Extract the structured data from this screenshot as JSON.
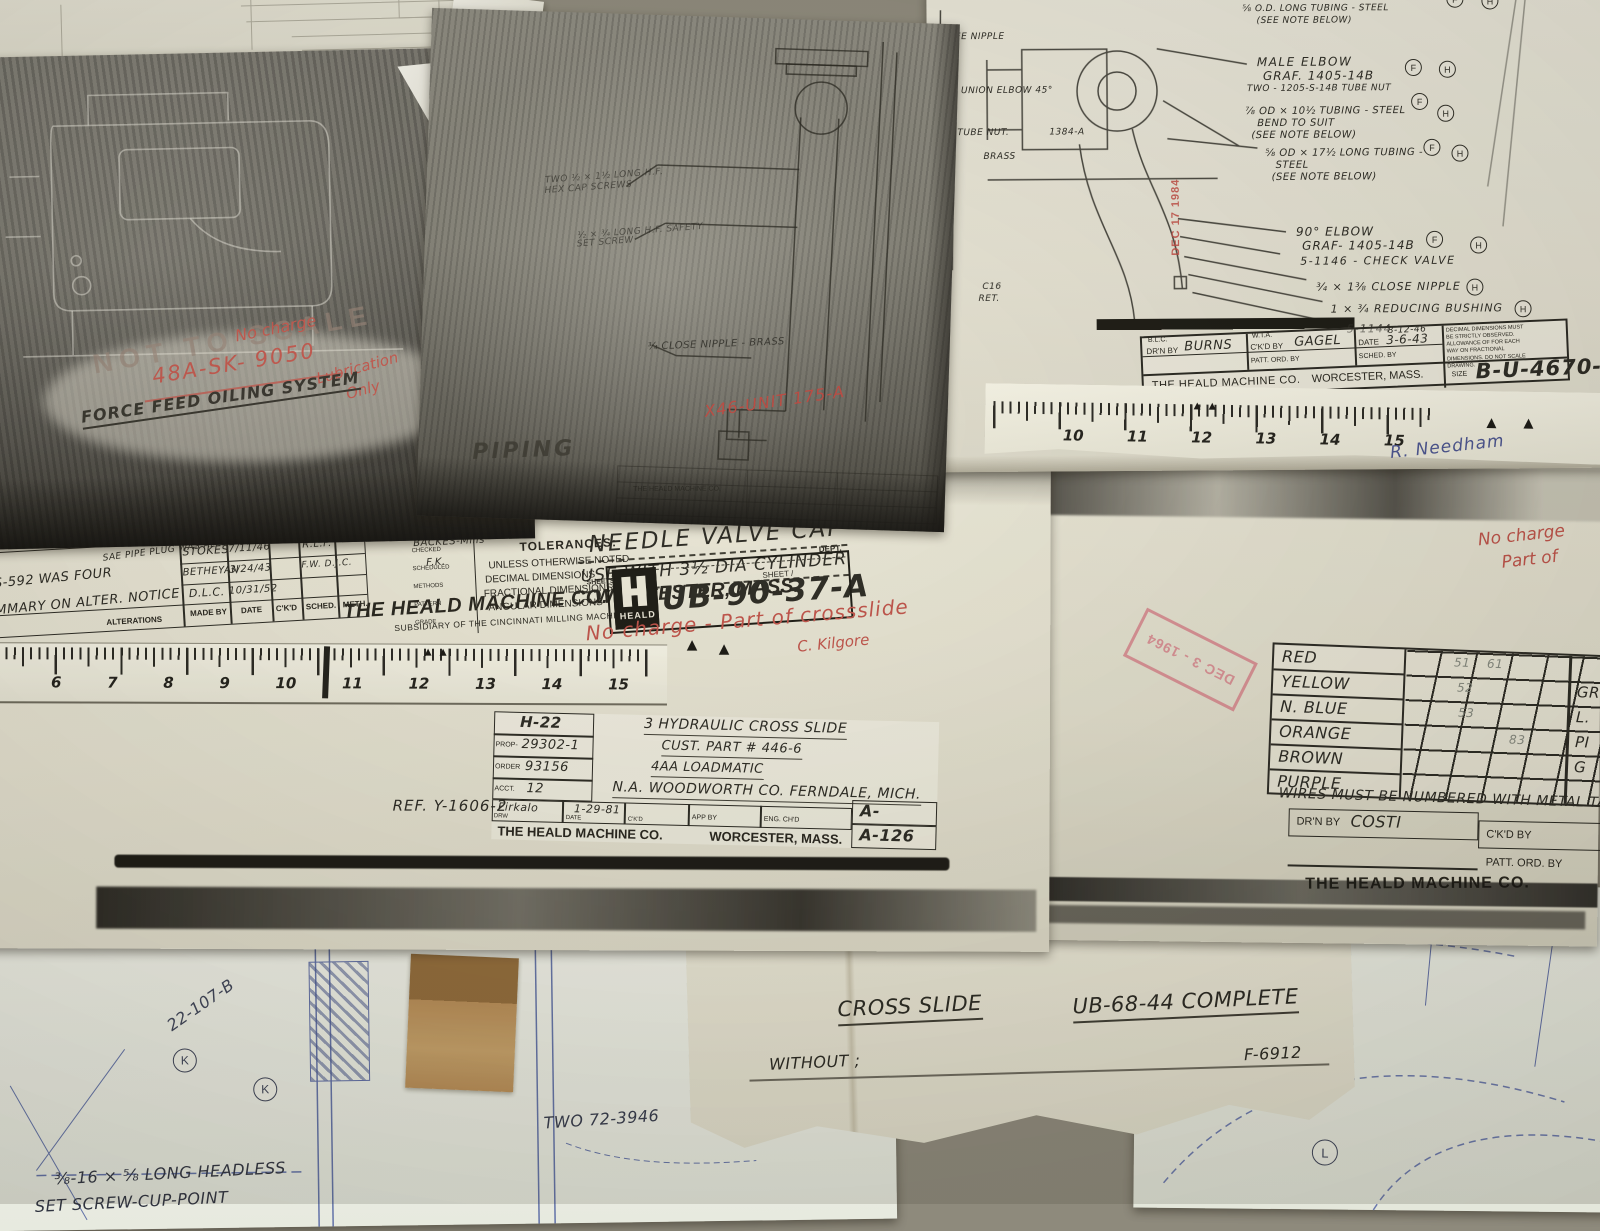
{
  "dark_print_left": {
    "stamp_not_to_scale": "NOT TO SCALE",
    "red_no_charge": "No charge",
    "red_sketch_number": "48A-SK- 9050",
    "red_lubrication": "Lubrication",
    "red_only": "Only",
    "system_title": "FORCE FEED OILING SYSTEM"
  },
  "dark_print_mid": {
    "note_cap_screws_1": "TWO ½ × 1½ LONG H.F.",
    "note_cap_screws_2": "HEX CAP SCREWS",
    "note_set_screw_1": "½ × ¾ LONG H.F. SAFETY",
    "note_set_screw_2": "SET SCREW",
    "note_close_nipple": "¾ CLOSE NIPPLE - BRASS",
    "red_unit": "X46-UNIT 175-A",
    "piping_label": "PIPING",
    "company_small": "THE HEALD MACHINE CO."
  },
  "sheet_b_u_4670": {
    "top_fragments": {
      "graf": "GRAF. 1405-14",
      "tubing": "⅝ O.D. LONG TUBING - STEEL",
      "see_note": "(SEE NOTE BELOW)"
    },
    "left_fragments": {
      "see_nipple": "SEE NIPPLE",
      "union_elbow": "UNION ELBOW 45°",
      "tube_nut": "TUBE NUT.",
      "part_1384": "1384-A",
      "brass": "BRASS",
      "c16": "C16",
      "ret": "RET."
    },
    "annotations": [
      {
        "l1": "MALE ELBOW",
        "l2": "GRAF. 1405-14B",
        "l3": "TWO - 1205-S-14B TUBE NUT",
        "m1": "F",
        "m2": "H"
      },
      {
        "l1": "⅞ OD × 10½ TUBING - STEEL",
        "l2": "BEND TO SUIT",
        "l3": "(SEE NOTE BELOW)",
        "m1": "F",
        "m2": "H"
      },
      {
        "l1": "⅝ OD × 17½ LONG TUBING -",
        "l2": "STEEL",
        "l3": "(SEE NOTE BELOW)",
        "m1": "F",
        "m2": "H"
      },
      {
        "l1": "90° ELBOW",
        "l2": "GRAF- 1405-14B",
        "m1": "F",
        "m2": "H"
      },
      {
        "l1": "5-1146 - CHECK VALVE"
      },
      {
        "l1": "¾ × 1⅜ CLOSE NIPPLE",
        "m1": "H"
      },
      {
        "l1": "1 × ¾ REDUCING BUSHING",
        "m1": "H"
      },
      {
        "l1": "5-1144"
      }
    ],
    "stamp_date": "DEC 17 1984",
    "title_block": {
      "drn_super": "B.L.C.",
      "drn_label": "DR'N BY",
      "drn_value": "BURNS",
      "ckd_super": "W.T.A.",
      "ckd_label": "C'K'D BY",
      "ckd_value": "GAGEL",
      "date_super": "8-12-46",
      "date_label": "DATE",
      "date_value": "3-6-43",
      "patt_label": "PATT. ORD. BY",
      "sched_label": "SCHED. BY",
      "notes": "DECIMAL DIMENSIONS MUST BE STRICTLY OBSERVED. ALLOWANCE OF FOR EACH WAY ON FRACTIONAL DIMENSIONS. DO NOT SCALE DRAWING.",
      "company": "THE HEALD MACHINE CO.",
      "city": "WORCESTER, MASS.",
      "size_label": "SIZE",
      "number": "B-U-4670-H"
    },
    "schedule_note": "SEE ALSO SCHEDULE U-4578-H"
  },
  "ruler_right": {
    "numbers": [
      "10",
      "11",
      "12",
      "13",
      "14",
      "15"
    ],
    "signature": "R. Needham"
  },
  "sheet_wires": {
    "red_note_1": "No charge",
    "red_note_2": "Part of",
    "stamp_date": "DEC 3 - 1964",
    "table_rows": [
      {
        "label": "RED",
        "v1": "51",
        "v2": "61"
      },
      {
        "label": "YELLOW",
        "v1": "52",
        "v2": ""
      },
      {
        "label": "N. BLUE",
        "v1": "53",
        "v2": ""
      },
      {
        "label": "ORANGE",
        "v1": "",
        "v2": "83"
      },
      {
        "label": "BROWN",
        "v1": "",
        "v2": ""
      },
      {
        "label": "PURPLE",
        "v1": "",
        "v2": ""
      }
    ],
    "right_fragments": [
      "GR",
      "L.",
      "PI",
      "G"
    ],
    "wires_note": "WIRES MUST BE NUMBERED WITH METAL TAGS TO",
    "drn_label": "DR'N BY",
    "drn_value": "COSTI",
    "ckd_label": "C'K'D BY",
    "date_label": "DATE",
    "patt_label": "PATT. ORD. BY",
    "sched_label": "SCH",
    "company": "THE HEALD MACHINE CO."
  },
  "sheet_ub_90_37": {
    "heat_treatment": "HEAT TREATMENT",
    "rockwell": "ROCKWELL \"C\"",
    "part_name": "NEEDLE VALVE CAP",
    "part_use": "USE WITH 3½ DIA CYLINDER",
    "tolerances_title": "TOLERANCES:",
    "tol_1": "UNLESS OTHERWISE NOTED",
    "tol_2": "DECIMAL DIMENSIONS",
    "tol_2v": "± .005",
    "tol_3": "FRACTIONAL DIMENSIONS",
    "tol_3v": "± 1/64",
    "tol_4": "ANGULAR DIMENSIONS",
    "side_rows": [
      {
        "label": "CHECKED",
        "value": "BACKES-Mills"
      },
      {
        "label": "SCHEDULED",
        "value": "F.K."
      },
      {
        "label": "METHODS",
        "value": ""
      },
      {
        "label": "PATTERN",
        "value": ""
      },
      {
        "label": "GRADE",
        "value": ""
      }
    ],
    "company": "THE HEALD MACHINE CO.",
    "city": "WORCESTER, MASS.",
    "subsidiary": "SUBSIDIARY OF THE CINCINNATI MILLING MACHINE CO.",
    "sheets_label": "SHEETS",
    "sheet_label": "SHEET /",
    "dept_label": "DEPT.",
    "logo": "HEALD",
    "number": "UB-90-37-A",
    "red_note": "No charge - Part of crossslide",
    "red_sig": "C. Kilgore",
    "alterations": {
      "frag1": "F-9285 WAS",
      "frag2": "SAE PIPE PLUG WAS ALLEN",
      "row1": "S-592 WAS FOUR",
      "row2": "...MMARY ON  ALTER.  NOTICE",
      "header": "ALTERATIONS",
      "made_by": [
        "STOKES",
        "BETHEYAN",
        "D.L.C."
      ],
      "dates": [
        "7/11/46",
        "3/24/43",
        "10/31/52"
      ],
      "sched": [
        "R.L.F.",
        "F.W. D.J.C."
      ],
      "cols": [
        "MADE BY",
        "DATE",
        "C'K'D",
        "SCHED.",
        "METH."
      ]
    }
  },
  "ruler_left": {
    "numbers": [
      "6",
      "7",
      "8",
      "9",
      "10",
      "11",
      "12",
      "13",
      "14",
      "15"
    ]
  },
  "sheet_cross_slide_block": {
    "h22": "H-22",
    "prop_label": "PROP-",
    "prop": "29302-1",
    "order_label": "ORDER",
    "order": "93156",
    "acct_label": "ACCT.",
    "acct": "12",
    "line1": "3 HYDRAULIC CROSS SLIDE",
    "line2": "CUST. PART # 446-6",
    "line3": "4AA LOADMATIC",
    "line4": "N.A. WOODWORTH CO. FERNDALE, MICH.",
    "drw_label": "DRW",
    "drw": "Firkalo",
    "date_label": "DATE",
    "date": "1-29-81",
    "ckd_label": "C'K'D",
    "app_label": "APP BY",
    "eng_label": "ENG. CH'D",
    "a_blank": "A-",
    "a_num": "A-126",
    "company": "THE HEALD MACHINE CO.",
    "city": "WORCESTER, MASS.",
    "ref": "REF. Y-1606-2"
  },
  "sheet_cross_slide_note": {
    "title_1": "CROSS SLIDE",
    "title_2": "UB-68-44 COMPLETE",
    "line2": "WITHOUT ;",
    "line2_end": "F-6912"
  },
  "blueprint_left": {
    "part": "22-107-B",
    "k": "K",
    "screw_1": "⅜-16 × ⅝ LONG HEADLESS",
    "screw_2": "SET SCREW-CUP-POINT",
    "two": "TWO 72-3946"
  },
  "blueprint_right": {
    "l": "L"
  }
}
